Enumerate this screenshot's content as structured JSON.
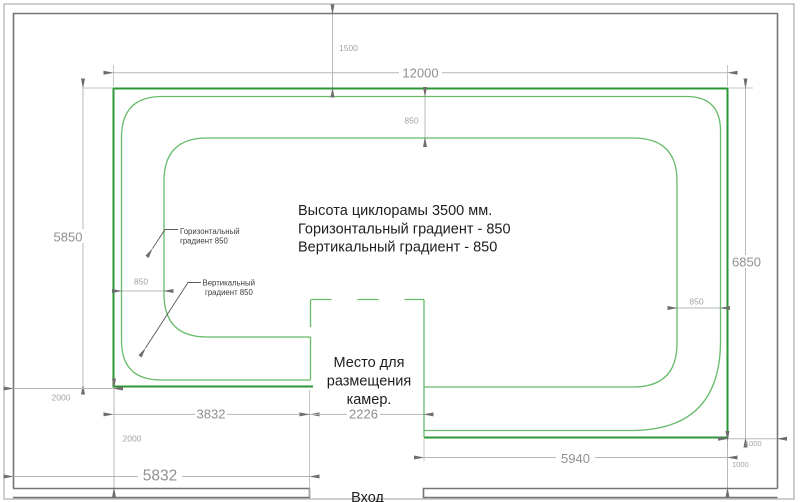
{
  "colors": {
    "background": "#ffffff",
    "cyclorama_outline": "#2b9733",
    "cyclorama_inner": "#66bb69",
    "dimension_line": "#b3b8b8",
    "dimension_text": "#8f8f8f",
    "arrow": "#6e6e6e",
    "wall": "#757575",
    "frame": "#9e9e9e",
    "text": "#1e1e1e"
  },
  "info_note": {
    "line1": "Высота циклорамы 3500 мм.",
    "line2": "Горизонтальный градиент - 850",
    "line3": "Вертикальный градиент - 850"
  },
  "camera_note": {
    "line1": "Место для",
    "line2": "размещения",
    "line3": "камер."
  },
  "entrance_label": "Вход",
  "callouts": {
    "horizontal_gradient": {
      "line1": "Горизонтальный",
      "line2": "градиент 850"
    },
    "vertical_gradient": {
      "line1": "Вертикальный",
      "line2": "градиент 850"
    }
  },
  "dimensions": {
    "ceiling_offset": "1500",
    "overall_width": "12000",
    "left_height": "5850",
    "right_height": "6850",
    "gradient_top": "850",
    "gradient_left": "850",
    "gradient_right": "850",
    "margin_left": "2000",
    "margin_bottom": "2000",
    "bottom_left_width": "3832",
    "niche_width": "2226",
    "bottom_right_width": "5940",
    "gap_right": "1000",
    "gap_bottom": "1000",
    "entrance_offset": "5832"
  }
}
